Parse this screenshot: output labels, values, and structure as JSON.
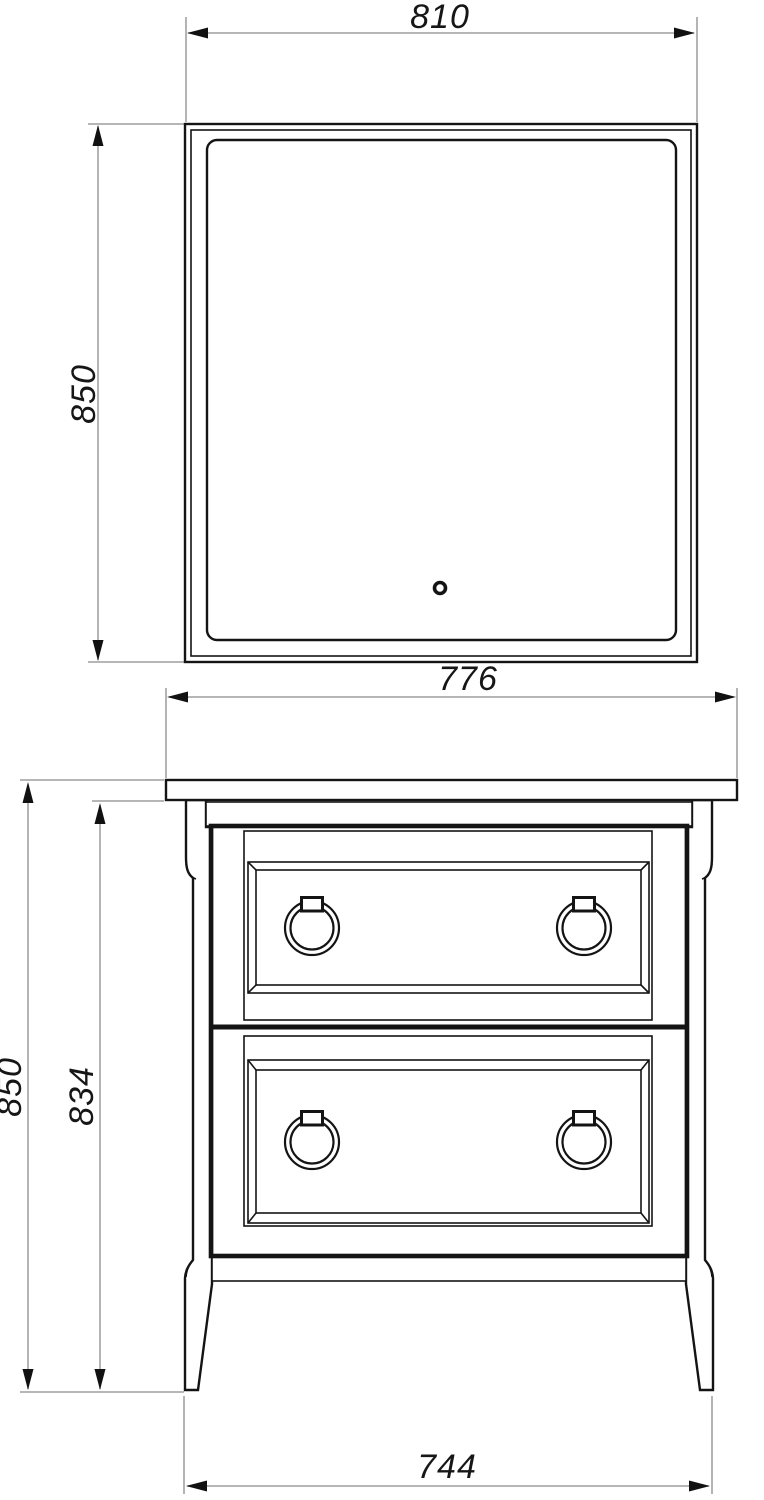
{
  "document": {
    "kind": "furniture dimension drawing",
    "line_color": "#141414",
    "dim_line_color": "#8b8b8b",
    "background": "#ffffff"
  },
  "mirror_view": {
    "label": "mirror front view with led contour and touch sensor",
    "dim_width": "810",
    "dim_height": "850"
  },
  "cabinet_view": {
    "label": "two-drawer vanity cabinet front view",
    "dim_top_width": "776",
    "dim_total_height": "850",
    "dim_body_height": "834",
    "dim_base_width": "744",
    "drawer_count": 2,
    "handles_per_drawer": 2
  }
}
